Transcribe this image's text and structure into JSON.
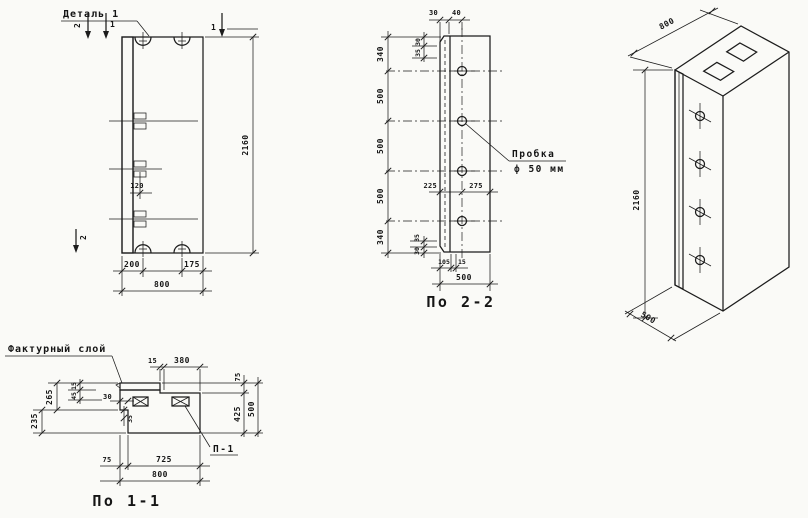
{
  "page": {
    "background": "#fafaf7",
    "ink": "#1c1c1c"
  },
  "front": {
    "detail_label": "Деталь 1",
    "marks": {
      "top_left_2": "2",
      "top_left_1": "1",
      "top_right_1": "1",
      "bottom_left_2": "2"
    },
    "dims": {
      "loop_offset": "120",
      "height": "2160",
      "left": "200",
      "right": "175",
      "width": "800"
    }
  },
  "s22": {
    "title": "По 2-2",
    "plug_label": {
      "line1": "Пробка",
      "line2": "ф 50 мм"
    },
    "dims": {
      "top": [
        "30",
        "40"
      ],
      "left_top": [
        "30",
        "35"
      ],
      "chain": [
        "340",
        "500",
        "500",
        "500",
        "340"
      ],
      "mid": [
        "225",
        "275"
      ],
      "left_bottom": [
        "35",
        "30"
      ],
      "bottom": [
        "105",
        "15"
      ],
      "width": "500"
    }
  },
  "iso": {
    "dims": {
      "width": "800",
      "height": "2160",
      "depth": "500"
    }
  },
  "s11": {
    "title": "По 1-1",
    "texture_label": "Фактурный слой",
    "plate_label": "П-1",
    "dims": {
      "top": [
        "15",
        "380"
      ],
      "left": [
        "265",
        "235"
      ],
      "inner": [
        "15",
        "45"
      ],
      "step": [
        "30",
        "35"
      ],
      "right": [
        "75",
        "425",
        "500"
      ],
      "bottom": [
        "75",
        "725",
        "800"
      ]
    }
  }
}
